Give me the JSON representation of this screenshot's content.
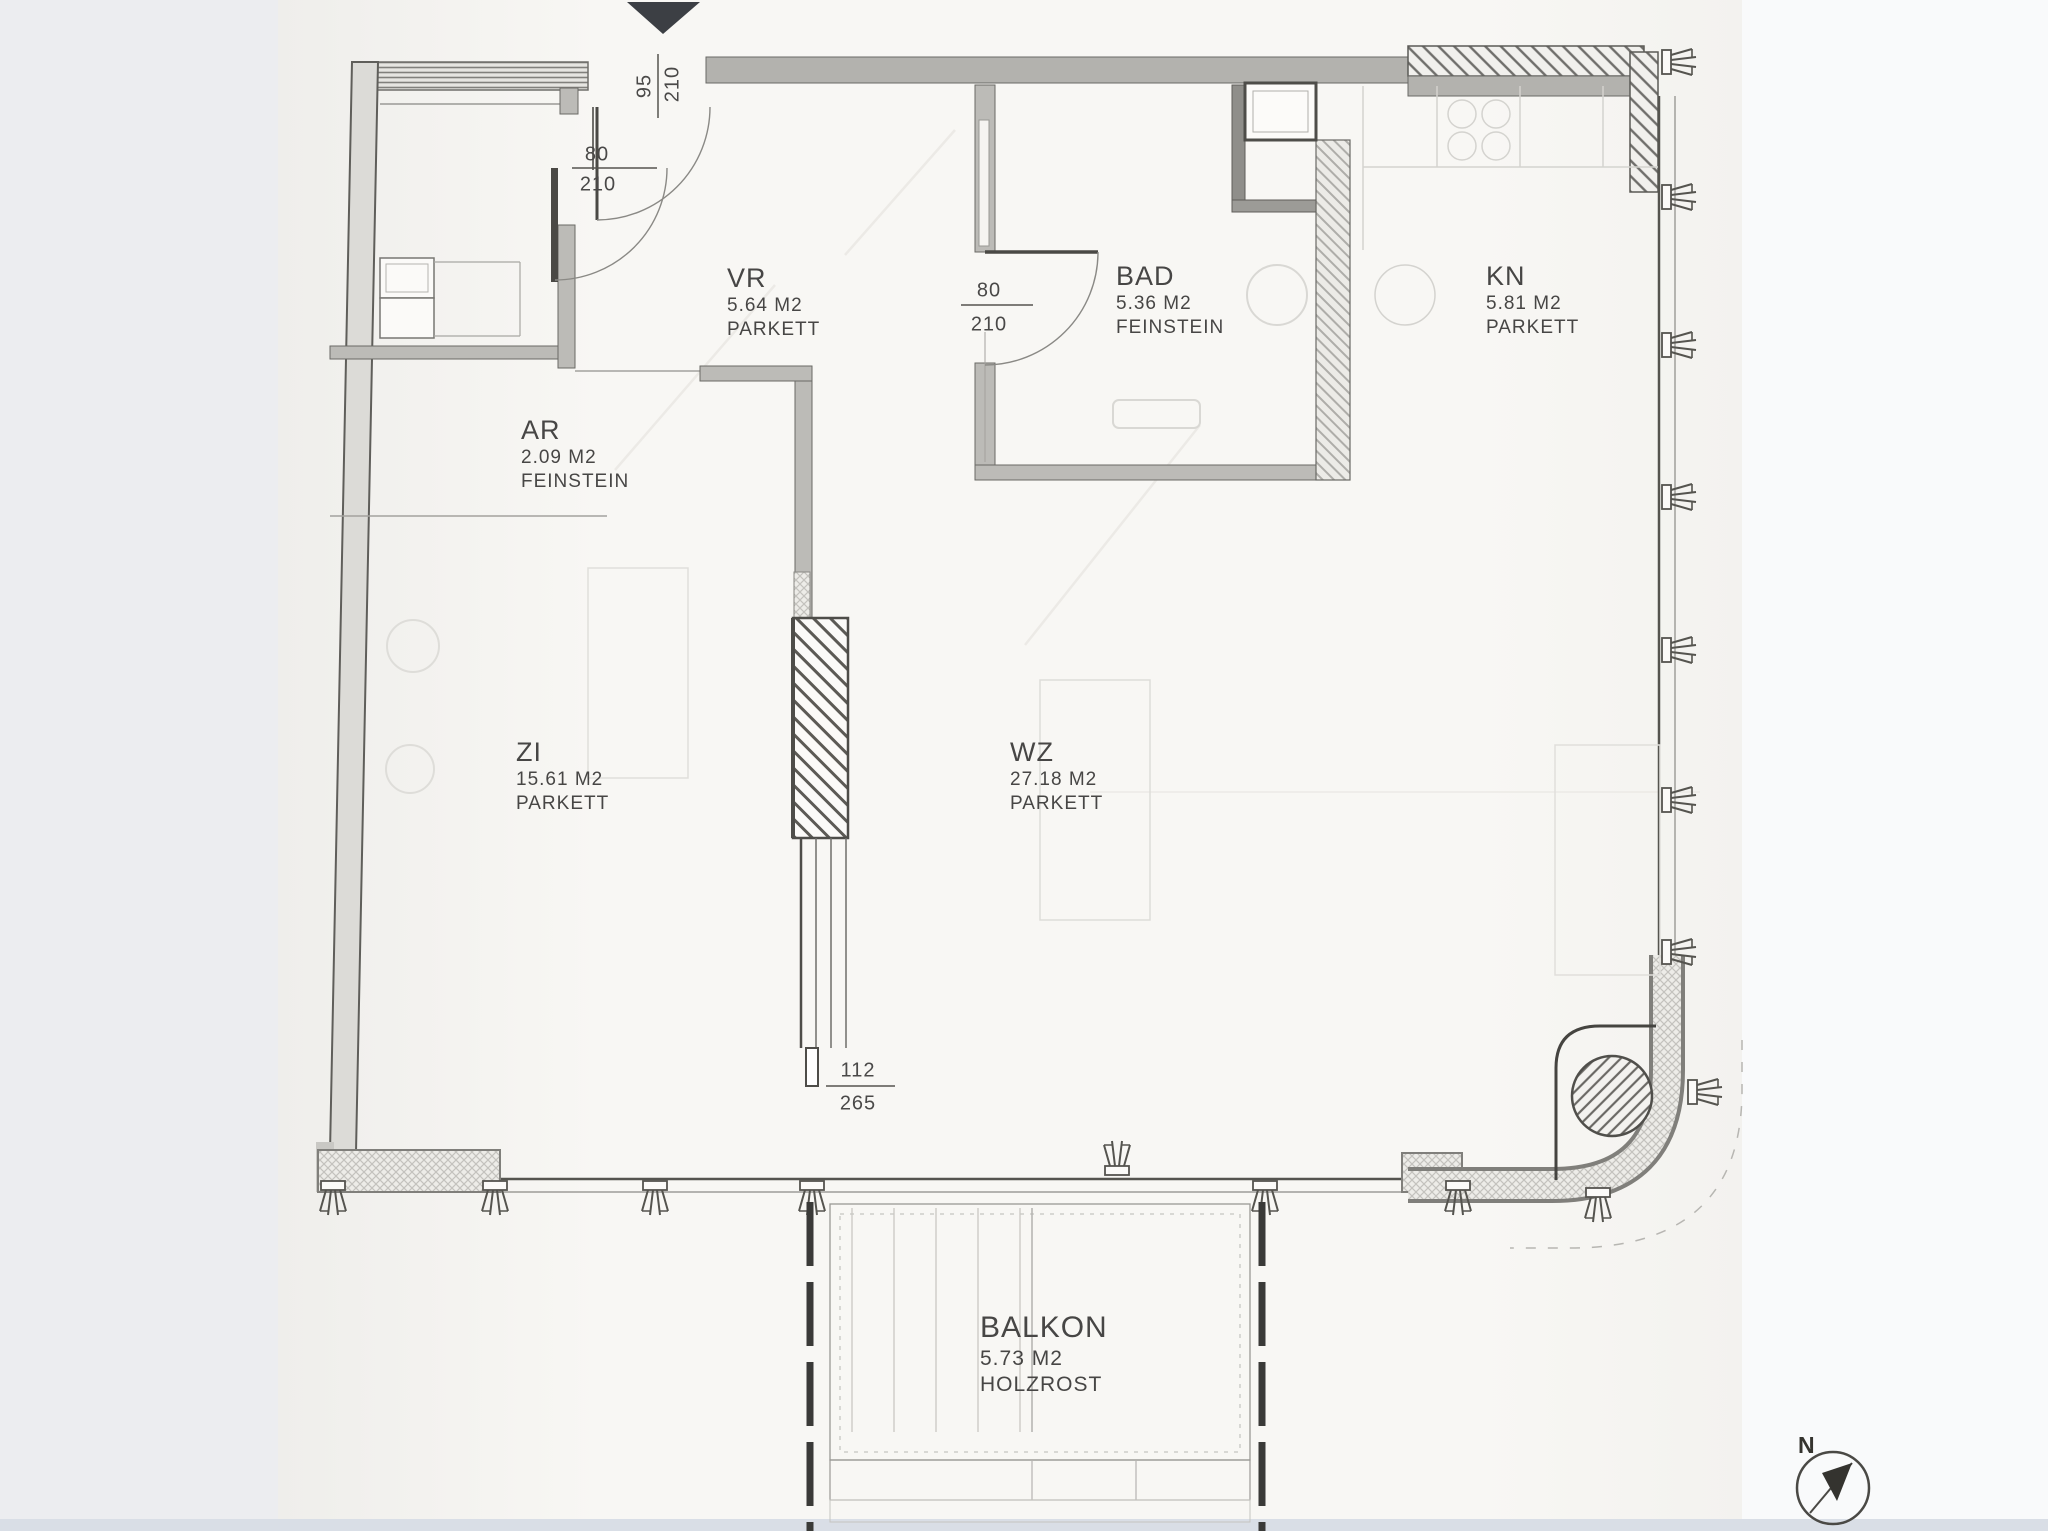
{
  "plan": {
    "rooms": [
      {
        "key": "vr",
        "name": "VR",
        "area": "5.64 M2",
        "floor": "PARKETT"
      },
      {
        "key": "bad",
        "name": "BAD",
        "area": "5.36 M2",
        "floor": "FEINSTEIN"
      },
      {
        "key": "kn",
        "name": "KN",
        "area": "5.81 M2",
        "floor": "PARKETT"
      },
      {
        "key": "ar",
        "name": "AR",
        "area": "2.09 M2",
        "floor": "FEINSTEIN"
      },
      {
        "key": "zi",
        "name": "ZI",
        "area": "15.61 M2",
        "floor": "PARKETT"
      },
      {
        "key": "wz",
        "name": "WZ",
        "area": "27.18 M2",
        "floor": "PARKETT"
      },
      {
        "key": "balkon",
        "name": "BALKON",
        "area": "5.73 M2",
        "floor": "HOLZROST"
      }
    ],
    "dimensions": {
      "entry_door": {
        "width": "95",
        "height": "210"
      },
      "ar_door": {
        "width": "80",
        "height": "210"
      },
      "bad_door": {
        "width": "80",
        "height": "210"
      },
      "zi_opening": {
        "width": "112",
        "height": "265"
      }
    },
    "compass": {
      "label": "N"
    },
    "colors": {
      "ink": "#4a4945",
      "wall_fill": "#bcbbb7",
      "paper": "#f8f7f4",
      "marker": "#3c3f44"
    }
  }
}
